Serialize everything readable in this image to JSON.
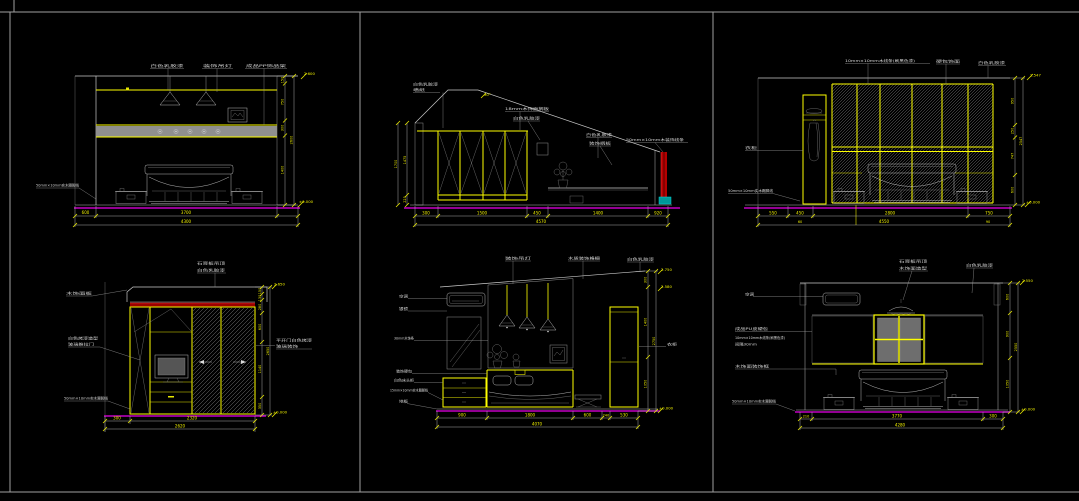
{
  "sheet": {
    "background": "#000000",
    "frame_color": "#9f9f9f"
  },
  "colors": {
    "yellow": "#ffff00",
    "magenta": "#c400c4",
    "red_band": "#9c0000",
    "teal": "#009898",
    "line_white": "#c9c9c9"
  },
  "p1": {
    "top_labels": [
      "白色乳胶漆",
      "装饰吊灯",
      "成品PP饰品架"
    ],
    "left_label": "50mm×10mm实木踢脚线",
    "bottom_dims": [
      "600",
      "3700"
    ],
    "bottom_total": "4300",
    "right_dims": [
      "150",
      "750",
      "300",
      "1400"
    ],
    "right_total": "2600",
    "level_top": "2.600",
    "level_bottom": "±0.000"
  },
  "p2": {
    "corner_labels": [
      "白色乳胶漆",
      "墙纸"
    ],
    "slope_label": "30°",
    "mid_labels": [
      "18mm木饰面搁板",
      "白色乳胶漆"
    ],
    "right_labels": [
      "白色乳胶漆",
      "装饰搁板",
      "50mm×10mm木装饰线条"
    ],
    "left_dims": [
      "1475",
      "225"
    ],
    "left_total": "1700",
    "bottom_dims": [
      "300",
      "1500",
      "450",
      "1400",
      "920"
    ],
    "bottom_total": "4570"
  },
  "p3": {
    "top_labels": [
      "10mm×10mm木线条(刷黑色漆)",
      "硬包饰面",
      "白色乳胶漆"
    ],
    "left_labels": [
      "衣柜",
      "50mm×10mm实木踢脚线"
    ],
    "bottom_dims": [
      "550",
      "450",
      "2800",
      "750"
    ],
    "bottom_row2": [
      "60",
      "4550",
      "90"
    ],
    "right_dims": [
      "950",
      "250",
      "747",
      "600"
    ],
    "right_total": "2547",
    "level_top": "2.547",
    "level_bottom": "±0.000"
  },
  "p4": {
    "top_labels": [
      "石膏板吊顶",
      "白色乳胶漆"
    ],
    "left_labels": [
      "木饰面板",
      "白色烤漆造型",
      "玻璃推拉门",
      "50mm×10mm实木踢脚线"
    ],
    "right_labels": [
      "平开门白色烤漆",
      "玻璃装饰"
    ],
    "bottom_dims": [
      "300",
      "2320"
    ],
    "bottom_total": "2620",
    "right_dims": [
      "150",
      "130",
      "280",
      "600",
      "1140",
      "350"
    ],
    "right_total": "2650",
    "level_top": "2.650",
    "level_bottom": "±0.000"
  },
  "p5": {
    "top_labels": [
      "装饰吊灯",
      "木质装饰格栅",
      "白色乳胶漆"
    ],
    "left_labels": [
      "空调",
      "银镜",
      "30mm木饰条",
      "装饰硬包",
      "白色床头柜",
      "15mm×10mm实木踢脚线",
      "地板"
    ],
    "right_label": "衣柜",
    "bottom_dims": [
      "900",
      "1800",
      "600",
      "240",
      "530"
    ],
    "bottom_total": "4070",
    "right_dims": [
      "300",
      "1400",
      "1050"
    ],
    "right_total": "2750",
    "level_top": "2.750",
    "level_top2": "2.580",
    "level_bottom": "±0.000"
  },
  "p6": {
    "top_labels": [
      "石膏板吊顶",
      "木饰面造型",
      "白色乳胶漆"
    ],
    "left_labels": [
      "空调",
      "成品PU皮硬包",
      "10mm×10mm木线条(刷黑色漆)",
      "间隔30mm",
      "木饰面装饰框",
      "50mm×10mm实木踢脚线"
    ],
    "bottom_dims": [
      "210",
      "3770",
      "300"
    ],
    "bottom_total": "4280",
    "right_dims": [
      "600",
      "900",
      "1050"
    ],
    "right_total": "2550",
    "level_top": "2.550",
    "level_bottom": "±0.000"
  }
}
